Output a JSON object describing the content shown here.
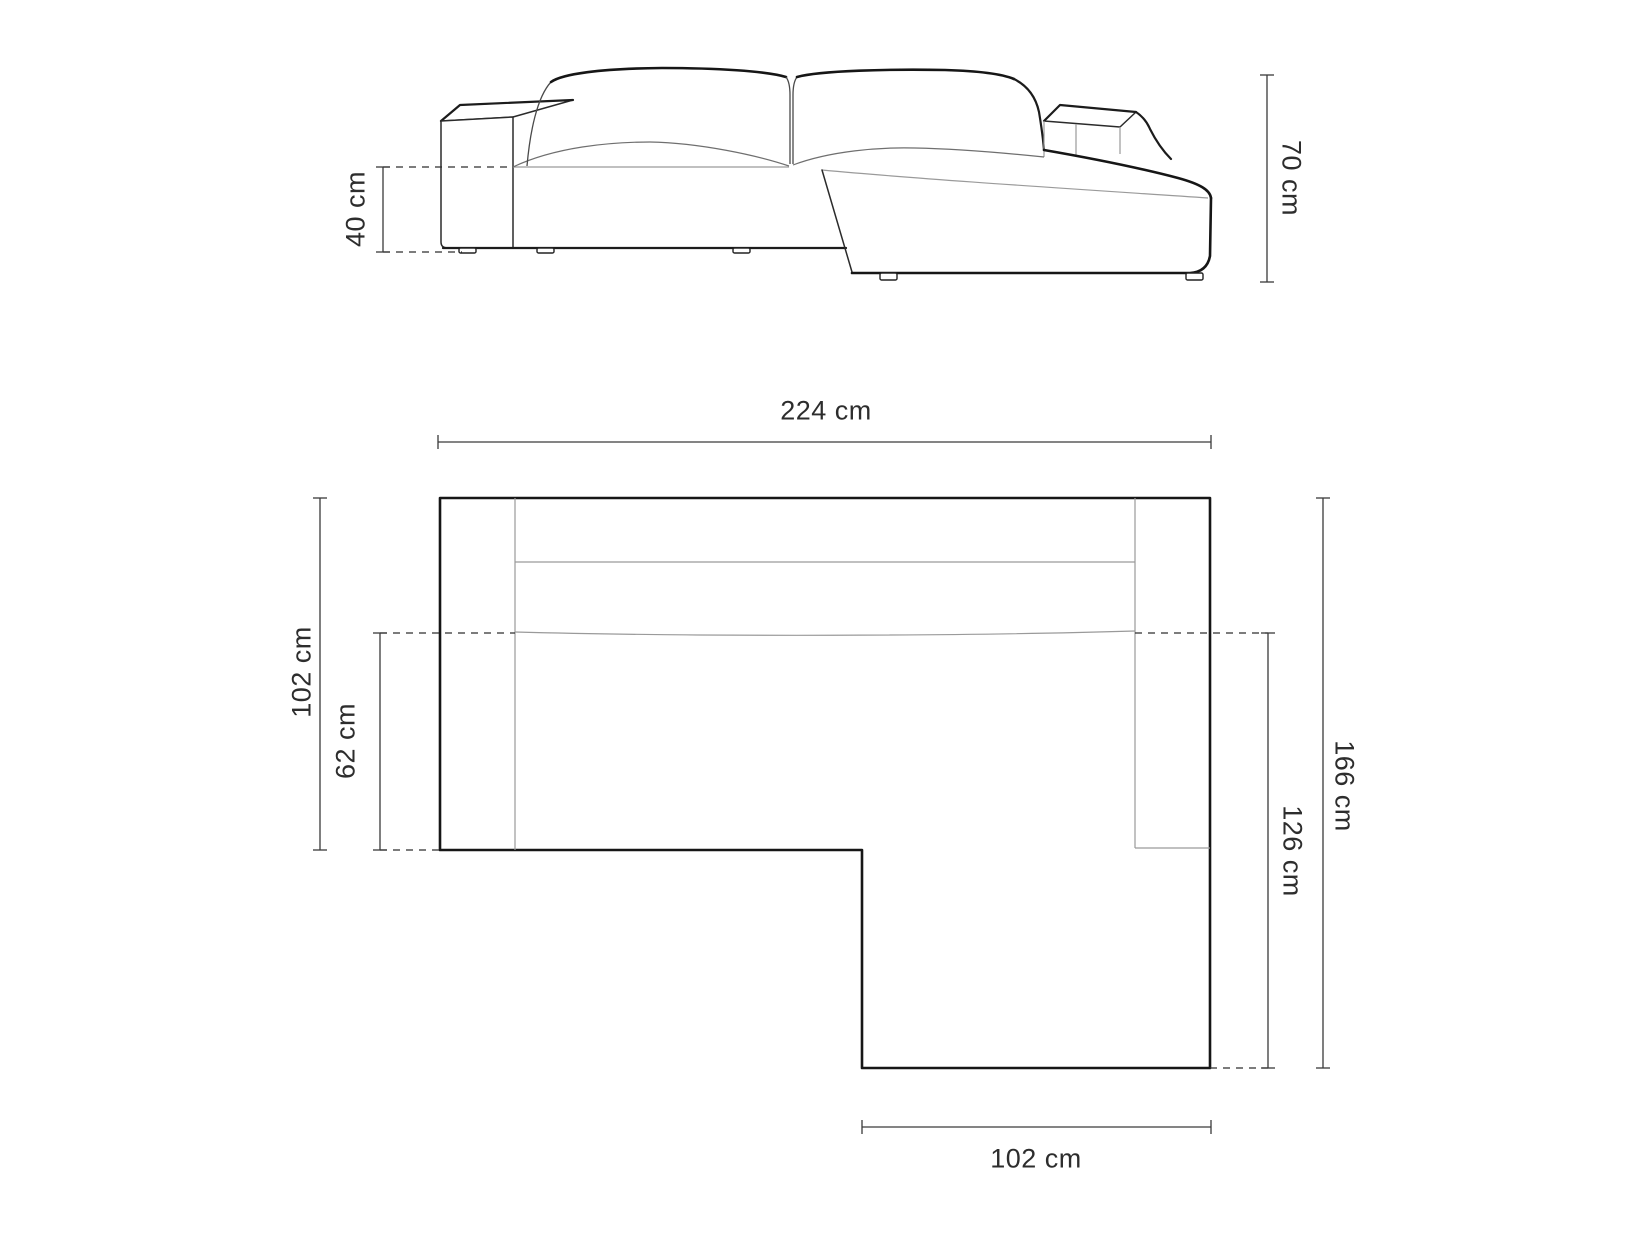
{
  "page": {
    "background_color": "#ffffff",
    "outline_color": "#161616",
    "dimension_line_color": "#3a3a3a",
    "label_color": "#2d2d2d",
    "unit": "cm",
    "description": "Technical dimension drawing of an L-shaped corner sofa: front elevation (top) and top plan view (bottom)"
  },
  "front_view": {
    "title": "sofa-front-elevation",
    "dims": {
      "seat_height": {
        "label": "40 cm",
        "value": 40,
        "unit": "cm",
        "orientation": "vertical-left"
      },
      "total_height": {
        "label": "70 cm",
        "value": 70,
        "unit": "cm",
        "orientation": "vertical-right"
      }
    }
  },
  "plan_view": {
    "title": "sofa-top-plan-view",
    "dims": {
      "total_width": {
        "label": "224 cm",
        "value": 224,
        "unit": "cm",
        "orientation": "horizontal-top"
      },
      "body_depth": {
        "label": "102 cm",
        "value": 102,
        "unit": "cm",
        "orientation": "vertical-left"
      },
      "seat_depth": {
        "label": "62 cm",
        "value": 62,
        "unit": "cm",
        "orientation": "vertical-left-inner"
      },
      "total_depth": {
        "label": "166 cm",
        "value": 166,
        "unit": "cm",
        "orientation": "vertical-right-outer"
      },
      "chaise_length": {
        "label": "126 cm",
        "value": 126,
        "unit": "cm",
        "orientation": "vertical-right-inner"
      },
      "chaise_width": {
        "label": "102 cm",
        "value": 102,
        "unit": "cm",
        "orientation": "horizontal-bottom"
      }
    }
  }
}
